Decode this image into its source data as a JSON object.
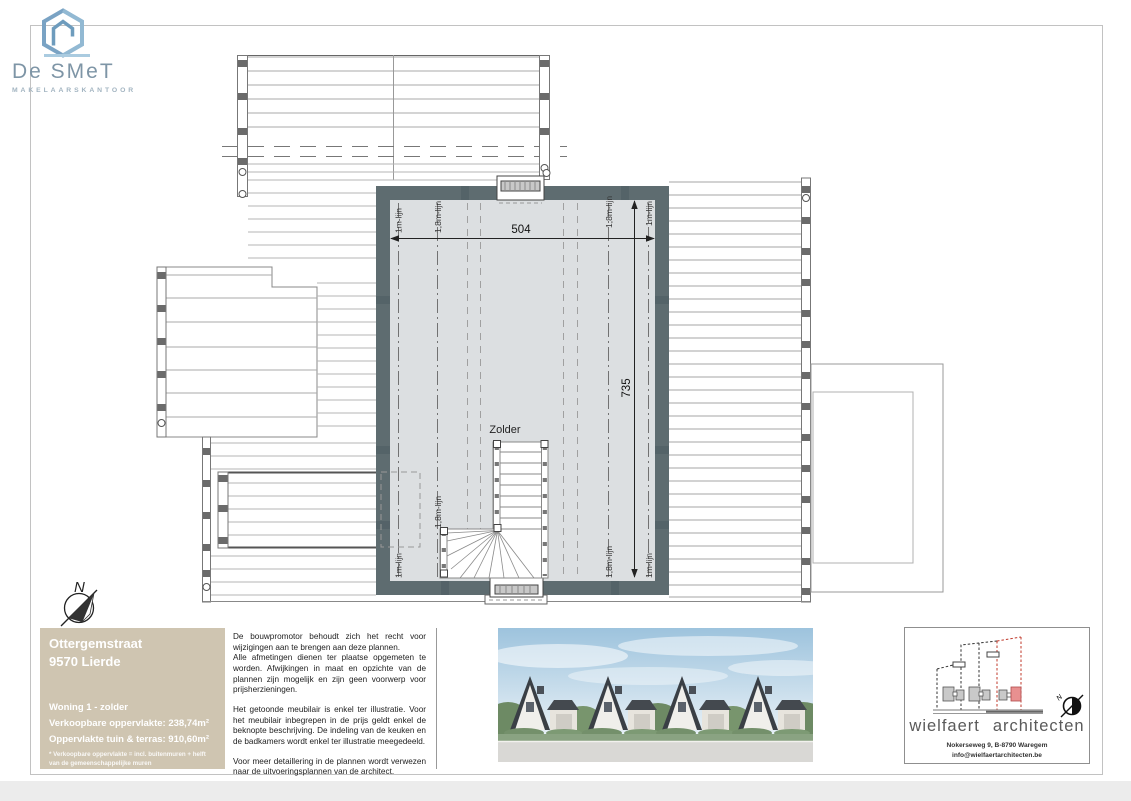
{
  "logo": {
    "name": "De SMeT",
    "subtitle": "MAKELAARSKANTOOR"
  },
  "north_label": "N",
  "plan": {
    "room_label": "Zolder",
    "dim_width": "504",
    "dim_height": "735",
    "label_1m": "1m-lijn",
    "label_18m": "1,8m-lijn"
  },
  "title_block": {
    "street": "Ottergemstraat",
    "city": "9570 Lierde",
    "unit": "Woning 1 - zolder",
    "area_sellable": "Verkoopbare oppervlakte: 238,74m²",
    "area_garden": "Oppervlakte tuin & terras: 910,60m²",
    "footnote": "* Verkoopbare oppervlakte = incl. buitenmuren + helft van de gemeenschappelijke muren"
  },
  "disclaimer": {
    "p1": "De bouwpromotor behoudt zich het recht voor wijzigingen aan te brengen aan deze plannen.",
    "p2": "Alle afmetingen dienen ter plaatse opgemeten te worden. Afwijkingen in maat en opzichte van de plannen zijn mogelijk en zijn geen voorwerp voor prijsherzieningen.",
    "p3": "Het getoonde meubilair is enkel ter illustratie. Voor het meubilair inbegrepen in de prijs geldt enkel de beknopte beschrijving. De indeling van de keuken en de badkamers wordt enkel ter illustratie meegedeeld.",
    "p4": "Voor meer detaillering in de plannen wordt verwezen naar de uitvoeringsplannen van de architect."
  },
  "architect": {
    "name_left": "wielfaert",
    "name_right": "architecten",
    "address": "Nokerseweg 9, B-8790 Waregem",
    "email": "info@wielfaertarchitecten.be",
    "compass_label": "N"
  },
  "colors": {
    "wall": "#5e6c70",
    "floor": "#dcdfe1",
    "tan": "#cfc5b1",
    "logo_blue": "#7aa3c4",
    "logo_text": "#7e95a6",
    "red_accent": "#e89090"
  }
}
